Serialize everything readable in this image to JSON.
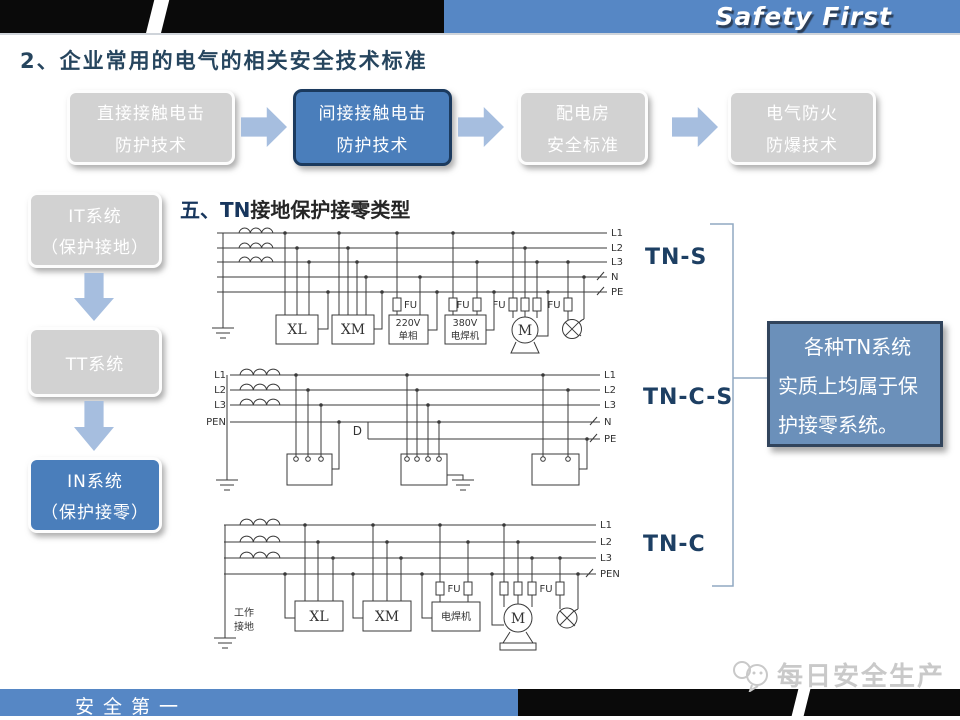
{
  "header": {
    "brand": "Safety First",
    "section_title": "2、企业常用的电气的相关安全技术标准"
  },
  "colors": {
    "bar_blue": "#5687c5",
    "active_blue": "#4a7ebb",
    "box_gray": "#d2d2d2",
    "navy_label": "#1d3f63",
    "note_blue": "#6b90ba"
  },
  "flow_row": {
    "items": [
      {
        "line1": "直接接触电击",
        "line2": "防护技术"
      },
      {
        "line1": "间接接触电击",
        "line2": "防护技术"
      },
      {
        "line1": "配电房",
        "line2": "安全标准"
      },
      {
        "line1": "电气防火",
        "line2": "防爆技术"
      }
    ]
  },
  "side_flow": {
    "items": [
      {
        "line1": "IT系统",
        "line2": "（保护接地）"
      },
      {
        "line1": "TT系统",
        "line2": ""
      },
      {
        "line1": "IN系统",
        "line2": "（保护接零）"
      }
    ]
  },
  "main": {
    "heading": {
      "num": "五、",
      "tn": "TN",
      "rest": "接地保护接零类型"
    },
    "system_labels": [
      "TN-S",
      "TN-C-S",
      "TN-C"
    ],
    "note_lines": [
      "各种TN系统",
      "实质上均属于保",
      "护接零系统。"
    ]
  },
  "diagrams": {
    "tns": {
      "bus_right": [
        "L1",
        "L2",
        "L3",
        "N",
        "PE"
      ],
      "xl": "XL",
      "xm": "XM",
      "load220": [
        "220V",
        "单相"
      ],
      "load380": [
        "380V",
        "电焊机"
      ],
      "motor": "M",
      "fu": "FU"
    },
    "tncs": {
      "bus_left": [
        "L1",
        "L2",
        "L3",
        "PEN"
      ],
      "bus_right": [
        "L1",
        "L2",
        "L3",
        "N",
        "PE"
      ],
      "d": "D"
    },
    "tnc": {
      "bus_right": [
        "L1",
        "L2",
        "L3",
        "PEN"
      ],
      "xl": "XL",
      "xm": "XM",
      "welder": "电焊机",
      "motor": "M",
      "fu": "FU",
      "work_ground": [
        "工作",
        "接地"
      ]
    }
  },
  "footer": {
    "slogan": "安全第一",
    "watermark": "每日安全生产"
  }
}
